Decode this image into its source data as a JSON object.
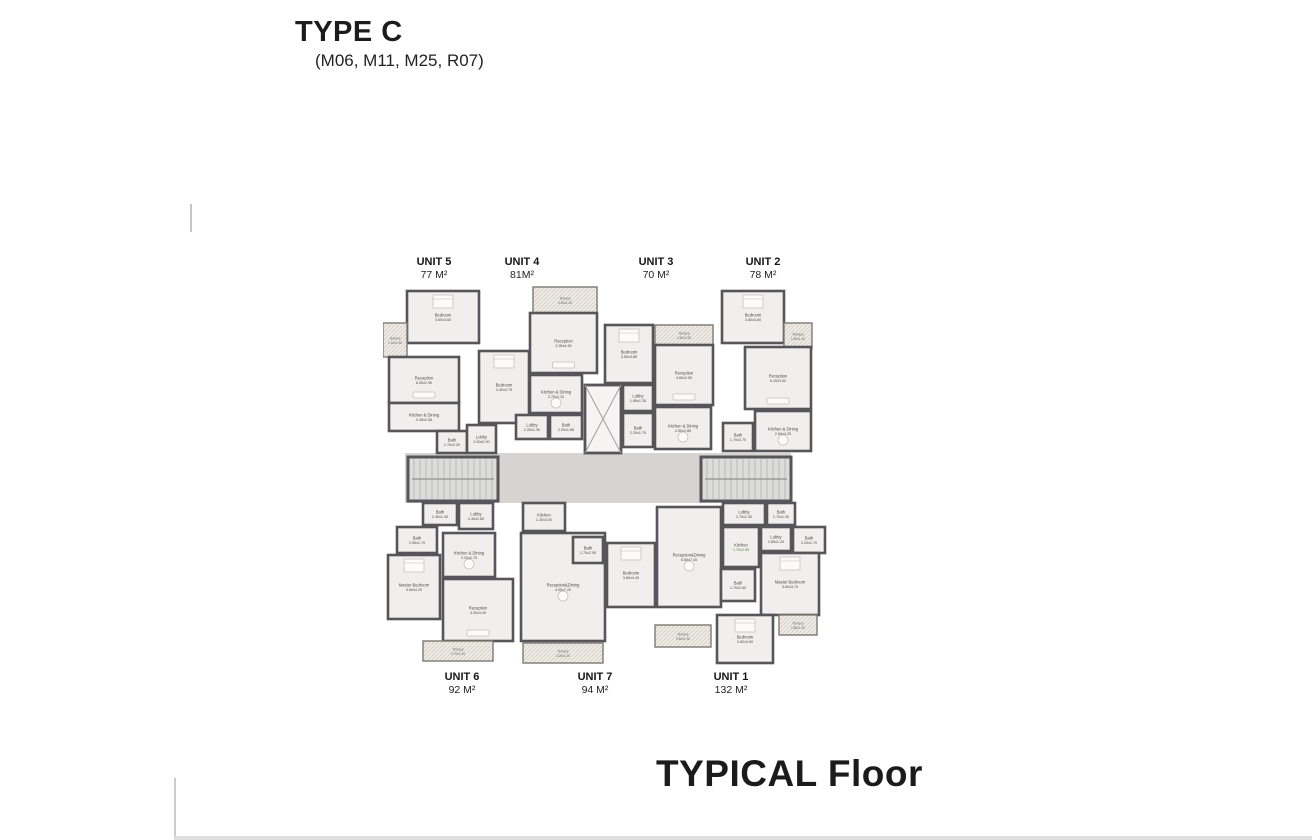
{
  "title": {
    "main": "TYPE C",
    "sub": "(M06, M11, M25, R07)"
  },
  "footer": {
    "label": "TYPICAL Floor"
  },
  "units": {
    "top": [
      {
        "name": "UNIT 5",
        "area": "77 M²"
      },
      {
        "name": "UNIT 4",
        "area": "81M²"
      },
      {
        "name": "UNIT 3",
        "area": "70 M²"
      },
      {
        "name": "UNIT 2",
        "area": "78 M²"
      }
    ],
    "bottom": [
      {
        "name": "UNIT 6",
        "area": "92 M²"
      },
      {
        "name": "UNIT 7",
        "area": "94 M²"
      },
      {
        "name": "UNIT 1",
        "area": "132 M²"
      }
    ]
  },
  "plan": {
    "colors": {
      "wall": "#56565a",
      "room": "#f1efed",
      "corridor": "#d5d4d2",
      "stair": "#dcdcdb",
      "terrace": "#efece6",
      "elevator": "#f5f4f3",
      "label": "#4c4a47",
      "furniture": "#c6c2bc"
    },
    "corridor": {
      "x": 22,
      "y": 168,
      "w": 386,
      "h": 50
    },
    "stairs": [
      {
        "side": "left",
        "x": 25,
        "y": 172,
        "w": 90,
        "h": 44
      },
      {
        "side": "right",
        "x": 318,
        "y": 172,
        "w": 90,
        "h": 44
      }
    ],
    "elevator": {
      "x": 202,
      "y": 100,
      "w": 36,
      "h": 68
    },
    "rooms": [
      {
        "unit": "5",
        "name": "Bedroom",
        "dims": "3.60x3.60",
        "type": "room",
        "furn": "bed",
        "x": 24,
        "y": 6,
        "w": 72,
        "h": 52
      },
      {
        "unit": "5",
        "name": "Terrace",
        "dims": "1.15x1.60",
        "type": "terrace",
        "x": 0,
        "y": 38,
        "w": 24,
        "h": 34
      },
      {
        "unit": "5",
        "name": "Reception",
        "dims": "6.00x2.90",
        "type": "room",
        "furn": "sofa",
        "x": 6,
        "y": 72,
        "w": 70,
        "h": 46
      },
      {
        "unit": "5",
        "name": "Kitchen & Dining",
        "dims": "3.45x2.55",
        "type": "room",
        "x": 6,
        "y": 118,
        "w": 70,
        "h": 28
      },
      {
        "unit": "5",
        "name": "Bath",
        "dims": "1.70x2.20",
        "type": "room",
        "x": 54,
        "y": 146,
        "w": 30,
        "h": 22
      },
      {
        "unit": "5",
        "name": "Lobby",
        "dims": "2.00x2.20",
        "type": "room",
        "x": 84,
        "y": 140,
        "w": 29,
        "h": 28
      },
      {
        "unit": "4",
        "name": "Terrace",
        "dims": "4.25x1.30",
        "type": "terrace",
        "x": 150,
        "y": 2,
        "w": 64,
        "h": 26
      },
      {
        "unit": "4",
        "name": "Reception",
        "dims": "3.95x4.55",
        "type": "room",
        "furn": "sofa",
        "x": 147,
        "y": 28,
        "w": 67,
        "h": 60
      },
      {
        "unit": "4",
        "name": "Bedroom",
        "dims": "3.40x4.75",
        "type": "room",
        "furn": "bed",
        "x": 96,
        "y": 66,
        "w": 50,
        "h": 72
      },
      {
        "unit": "4",
        "name": "Kitchen & Dining",
        "dims": "2.70x2.10",
        "type": "room",
        "furn": "table",
        "x": 147,
        "y": 90,
        "w": 52,
        "h": 38
      },
      {
        "unit": "4",
        "name": "Lobby",
        "dims": "2.20x1.30",
        "type": "room",
        "x": 133,
        "y": 130,
        "w": 32,
        "h": 24
      },
      {
        "unit": "4",
        "name": "Bath",
        "dims": "2.20x1.65",
        "type": "room",
        "x": 167,
        "y": 130,
        "w": 32,
        "h": 24
      },
      {
        "unit": "3",
        "name": "Bedroom",
        "dims": "3.50x3.80",
        "type": "room",
        "furn": "bed",
        "x": 222,
        "y": 40,
        "w": 48,
        "h": 58
      },
      {
        "unit": "3",
        "name": "Terrace",
        "dims": "1.50x3.25",
        "type": "terrace",
        "x": 272,
        "y": 40,
        "w": 58,
        "h": 20
      },
      {
        "unit": "3",
        "name": "Reception",
        "dims": "4.60x2.50",
        "type": "room",
        "furn": "sofa",
        "x": 272,
        "y": 60,
        "w": 58,
        "h": 60
      },
      {
        "unit": "3",
        "name": "Lobby",
        "dims": "1.85x1.35",
        "type": "room",
        "x": 240,
        "y": 100,
        "w": 30,
        "h": 26
      },
      {
        "unit": "3",
        "name": "Bath",
        "dims": "2.20x1.70",
        "type": "room",
        "x": 240,
        "y": 128,
        "w": 30,
        "h": 34
      },
      {
        "unit": "3",
        "name": "Kitchen & Dining",
        "dims": "2.90x2.85",
        "type": "room",
        "furn": "table",
        "x": 272,
        "y": 122,
        "w": 56,
        "h": 42
      },
      {
        "unit": "2",
        "name": "Bedroom",
        "dims": "3.60x3.60",
        "type": "room",
        "furn": "bed",
        "x": 339,
        "y": 6,
        "w": 62,
        "h": 52
      },
      {
        "unit": "2",
        "name": "Terrace",
        "dims": "1.65x1.10",
        "type": "terrace",
        "x": 401,
        "y": 38,
        "w": 28,
        "h": 26
      },
      {
        "unit": "2",
        "name": "Reception",
        "dims": "6.10x3.00",
        "type": "room",
        "furn": "sofa",
        "x": 362,
        "y": 62,
        "w": 66,
        "h": 62
      },
      {
        "unit": "2",
        "name": "Kitchen & Dining",
        "dims": "2.60x4.25",
        "type": "room",
        "furn": "table",
        "x": 372,
        "y": 126,
        "w": 56,
        "h": 40
      },
      {
        "unit": "2",
        "name": "Bath",
        "dims": "1.70x2.70",
        "type": "room",
        "x": 340,
        "y": 138,
        "w": 30,
        "h": 28
      },
      {
        "unit": "6",
        "name": "Bath",
        "dims": "2.40x1.30",
        "type": "room",
        "x": 40,
        "y": 218,
        "w": 34,
        "h": 22
      },
      {
        "unit": "6",
        "name": "Lobby",
        "dims": "2.40x1.60",
        "type": "room",
        "x": 76,
        "y": 218,
        "w": 34,
        "h": 26
      },
      {
        "unit": "6",
        "name": "Bath",
        "dims": "2.55x1.70",
        "type": "room",
        "x": 14,
        "y": 242,
        "w": 40,
        "h": 26
      },
      {
        "unit": "6",
        "name": "Master Bedroom",
        "dims": "3.60x4.20",
        "type": "room",
        "furn": "bed",
        "x": 5,
        "y": 270,
        "w": 52,
        "h": 64
      },
      {
        "unit": "6",
        "name": "Kitchen & Dining",
        "dims": "2.20x2.75",
        "type": "room",
        "furn": "table",
        "x": 60,
        "y": 248,
        "w": 52,
        "h": 44
      },
      {
        "unit": "6",
        "name": "Reception",
        "dims": "4.00x3.40",
        "type": "room",
        "furn": "sofa",
        "x": 60,
        "y": 294,
        "w": 70,
        "h": 62
      },
      {
        "unit": "6",
        "name": "Terrace",
        "dims": "2.70x1.30",
        "type": "terrace",
        "x": 40,
        "y": 356,
        "w": 70,
        "h": 20
      },
      {
        "unit": "7",
        "name": "Kitchen",
        "dims": "1.30x3.00",
        "type": "room",
        "x": 140,
        "y": 218,
        "w": 42,
        "h": 28
      },
      {
        "unit": "7",
        "name": "Reception&Dining",
        "dims": "4.00x7.20",
        "type": "room",
        "furn": "table",
        "x": 138,
        "y": 248,
        "w": 84,
        "h": 108
      },
      {
        "unit": "7",
        "name": "Bath",
        "dims": "1.70x2.05",
        "type": "room",
        "x": 190,
        "y": 252,
        "w": 30,
        "h": 26
      },
      {
        "unit": "7",
        "name": "Terrace",
        "dims": "4.25x1.30",
        "type": "terrace",
        "x": 140,
        "y": 358,
        "w": 80,
        "h": 20
      },
      {
        "unit": "1",
        "name": "Bedroom",
        "dims": "3.60x4.40",
        "type": "room",
        "furn": "bed",
        "x": 224,
        "y": 258,
        "w": 48,
        "h": 64
      },
      {
        "unit": "1",
        "name": "Reception&Dining",
        "dims": "6.50x7.45",
        "type": "room",
        "furn": "table",
        "x": 274,
        "y": 222,
        "w": 64,
        "h": 100
      },
      {
        "unit": "1",
        "name": "Lobby",
        "dims": "3.70x1.30",
        "type": "room",
        "x": 340,
        "y": 218,
        "w": 42,
        "h": 22
      },
      {
        "unit": "1",
        "name": "Bath",
        "dims": "1.70x1.30",
        "type": "room",
        "x": 384,
        "y": 218,
        "w": 28,
        "h": 22
      },
      {
        "unit": "1",
        "name": "Kitchen",
        "dims": "1.75x2.85",
        "type": "room",
        "dim_color": "#4b8a3f",
        "x": 340,
        "y": 242,
        "w": 36,
        "h": 40
      },
      {
        "unit": "1",
        "name": "Lobby",
        "dims": "2.85x1.25",
        "type": "room",
        "x": 378,
        "y": 242,
        "w": 30,
        "h": 24
      },
      {
        "unit": "1",
        "name": "Bath",
        "dims": "2.20x1.70",
        "type": "room",
        "x": 410,
        "y": 242,
        "w": 32,
        "h": 26
      },
      {
        "unit": "1",
        "name": "Master Bedroom",
        "dims": "3.60x3.70",
        "type": "room",
        "furn": "bed",
        "x": 378,
        "y": 268,
        "w": 58,
        "h": 62
      },
      {
        "unit": "1",
        "name": "Bath",
        "dims": "1.70x2.60",
        "type": "room",
        "x": 338,
        "y": 284,
        "w": 34,
        "h": 32
      },
      {
        "unit": "1",
        "name": "Bedroom",
        "dims": "3.60x3.60",
        "type": "room",
        "furn": "bed",
        "x": 334,
        "y": 330,
        "w": 56,
        "h": 48
      },
      {
        "unit": "1",
        "name": "Terrace",
        "dims": "1.85x1.30",
        "type": "terrace",
        "x": 396,
        "y": 330,
        "w": 38,
        "h": 20
      },
      {
        "unit": "1",
        "name": "Terrace",
        "dims": "3.40x1.30",
        "type": "terrace",
        "x": 272,
        "y": 340,
        "w": 56,
        "h": 22
      }
    ]
  }
}
